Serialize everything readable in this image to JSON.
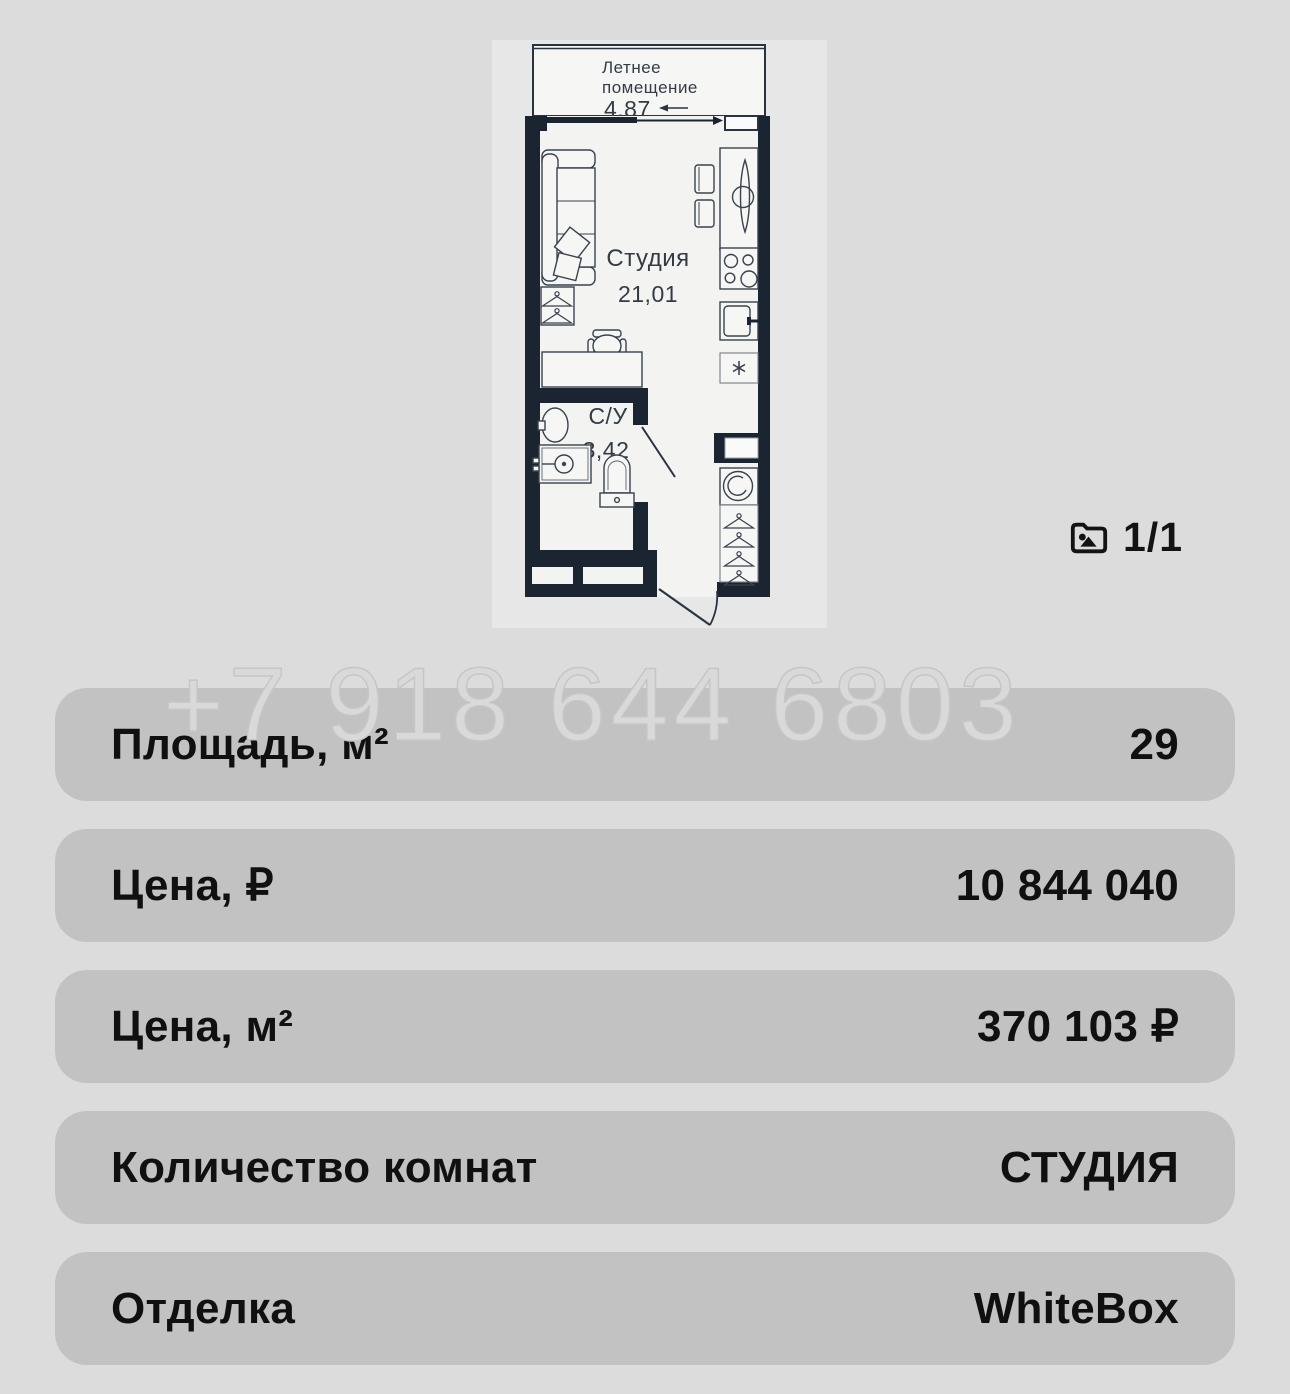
{
  "plan": {
    "balcony": {
      "label_line1": "Летнее",
      "label_line2": "помещение",
      "area": "4,87"
    },
    "studio": {
      "label": "Студия",
      "area": "21,01"
    },
    "bathroom": {
      "label": "С/У",
      "area": "3,42"
    }
  },
  "gallery": {
    "counter": "1/1",
    "icon": "folder-image-icon"
  },
  "watermark": {
    "phone": "+7 918 644 6803"
  },
  "details": [
    {
      "label": "Площадь, м²",
      "value": "29"
    },
    {
      "label": "Цена, ₽",
      "value": "10 844 040"
    },
    {
      "label": "Цена, м²",
      "value": "370 103 ₽"
    },
    {
      "label": "Количество комнат",
      "value": "СТУДИЯ"
    },
    {
      "label": "Отделка",
      "value": "WhiteBox"
    }
  ],
  "icons": {
    "kitchen_appliance": "asterisk-symbol",
    "closet": "hanger-icon"
  },
  "colors": {
    "page_bg": "#dcdcdc",
    "panel_bg": "#e7e7e7",
    "floor": "#f3f3f2",
    "wall": "#1b2531",
    "row_bg": "#c2c2c2",
    "text": "#101010",
    "watermark": "#d9d9d9"
  }
}
